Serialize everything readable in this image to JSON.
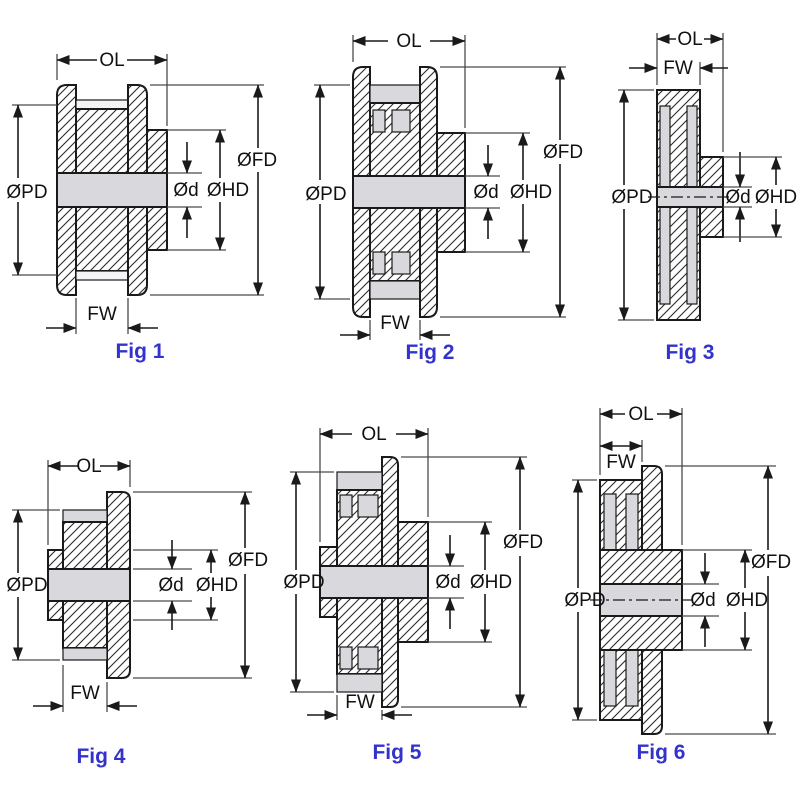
{
  "figures": [
    {
      "caption": "Fig 1",
      "labels": {
        "ol": "OL",
        "fw": "FW",
        "pd": "ØPD",
        "fd": "ØFD",
        "hd": "ØHD",
        "d": "Ød"
      }
    },
    {
      "caption": "Fig 2",
      "labels": {
        "ol": "OL",
        "fw": "FW",
        "pd": "ØPD",
        "fd": "ØFD",
        "hd": "ØHD",
        "d": "Ød"
      }
    },
    {
      "caption": "Fig 3",
      "labels": {
        "ol": "OL",
        "fw": "FW",
        "pd": "ØPD",
        "hd": "ØHD",
        "d": "Ød"
      }
    },
    {
      "caption": "Fig 4",
      "labels": {
        "ol": "OL",
        "fw": "FW",
        "pd": "ØPD",
        "fd": "ØFD",
        "hd": "ØHD",
        "d": "Ød"
      }
    },
    {
      "caption": "Fig 5",
      "labels": {
        "ol": "OL",
        "fw": "FW",
        "pd": "ØPD",
        "fd": "ØFD",
        "hd": "ØHD",
        "d": "Ød"
      }
    },
    {
      "caption": "Fig 6",
      "labels": {
        "ol": "OL",
        "fw": "FW",
        "pd": "ØPD",
        "fd": "ØFD",
        "hd": "ØHD",
        "d": "Ød"
      }
    }
  ],
  "colors": {
    "caption": "#3333cc",
    "line": "#1a1a1a",
    "fill_gray": "#d9d9dd",
    "background": "#ffffff"
  }
}
